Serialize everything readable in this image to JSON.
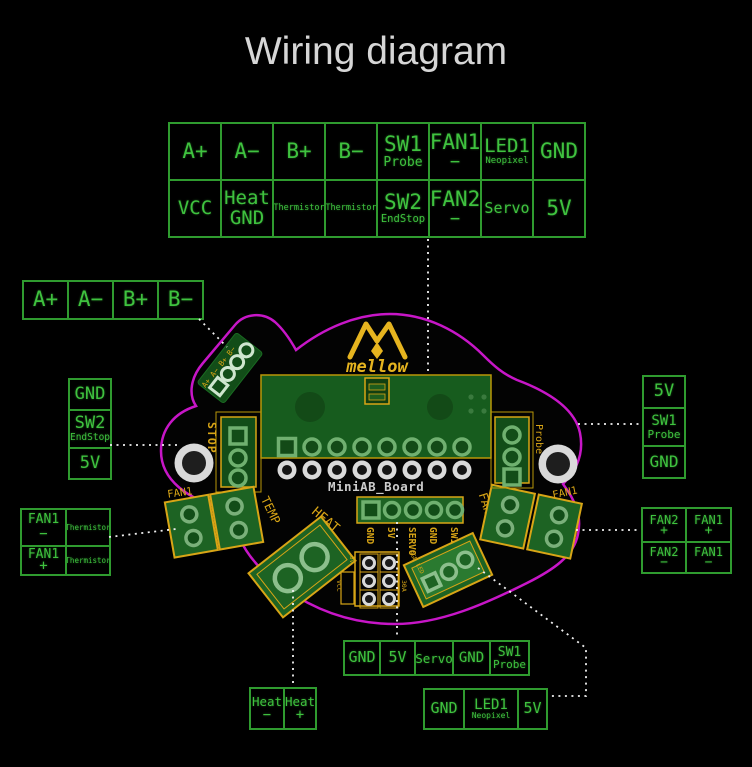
{
  "title": "Wiring diagram",
  "colors": {
    "green": "#3fc23f",
    "border": "#2f9b2f",
    "gold": "#d8a516",
    "magenta": "#c716c7",
    "white": "#f0f0f0"
  },
  "top_table": {
    "rows": [
      [
        {
          "t": "A+"
        },
        {
          "t": "A−"
        },
        {
          "t": "B+"
        },
        {
          "t": "B−"
        },
        {
          "t": "SW1",
          "s": "Probe"
        },
        {
          "t": "FAN1",
          "s": "−"
        },
        {
          "t": "LED1",
          "s": "Neopixel"
        },
        {
          "t": "GND"
        }
      ],
      [
        {
          "t": "VCC"
        },
        {
          "t": "Heat",
          "s": "GND"
        },
        {
          "t": "Thermistor"
        },
        {
          "t": "Thermistor"
        },
        {
          "t": "SW2",
          "s": "EndStop"
        },
        {
          "t": "FAN2",
          "s": "−"
        },
        {
          "t": "Servo"
        },
        {
          "t": "5V"
        }
      ]
    ]
  },
  "left_stepper_row": {
    "cells": [
      {
        "t": "A+"
      },
      {
        "t": "A−"
      },
      {
        "t": "B+"
      },
      {
        "t": "B−"
      }
    ]
  },
  "left_endstop_col": {
    "cells": [
      {
        "t": "GND"
      },
      {
        "t": "SW2",
        "s": "EndStop"
      },
      {
        "t": "5V"
      }
    ]
  },
  "left_fan_grid": {
    "cells": [
      {
        "t": "FAN1",
        "s": "−"
      },
      {
        "t": "Thermistor"
      },
      {
        "t": "FAN1",
        "s": "+"
      },
      {
        "t": "Thermistor"
      }
    ]
  },
  "right_probe_col": {
    "cells": [
      {
        "t": "5V"
      },
      {
        "t": "SW1",
        "s": "Probe"
      },
      {
        "t": "GND"
      }
    ]
  },
  "right_fan_grid": {
    "cells": [
      {
        "t": "FAN2",
        "s": "+"
      },
      {
        "t": "FAN1",
        "s": "+"
      },
      {
        "t": "FAN2",
        "s": "−"
      },
      {
        "t": "FAN1",
        "s": "−"
      }
    ]
  },
  "bottom_servo_row": {
    "cells": [
      {
        "t": "GND"
      },
      {
        "t": "5V"
      },
      {
        "t": "Servo"
      },
      {
        "t": "GND"
      },
      {
        "t": "SW1",
        "s": "Probe"
      }
    ]
  },
  "bottom_led_row": {
    "cells": [
      {
        "t": "GND"
      },
      {
        "t": "LED1",
        "s": "Neopixel"
      },
      {
        "t": "5V"
      }
    ]
  },
  "heat_row": {
    "cells": [
      {
        "t": "Heat",
        "s": "−"
      },
      {
        "t": "Heat",
        "s": "+"
      }
    ]
  },
  "board": {
    "name": "MiniAB_Board",
    "logo_text": "mellow",
    "stepper_pins": "A+ A− B+ B−",
    "stop_label": "STOP",
    "fan1_left_label": "FAN1",
    "temp_label": "TEMP",
    "heat_label": "HEAT",
    "header_labels": [
      "GND",
      "5V",
      "SERVO",
      "GND",
      "SW1"
    ],
    "vcc_label": "VCC",
    "v5_label": "5V",
    "amp_label": "30A",
    "rgb_label": "RGB LED",
    "fan2_label": "FAN2",
    "fan1_right_label": "FAN1",
    "probe_label": "Probe"
  }
}
